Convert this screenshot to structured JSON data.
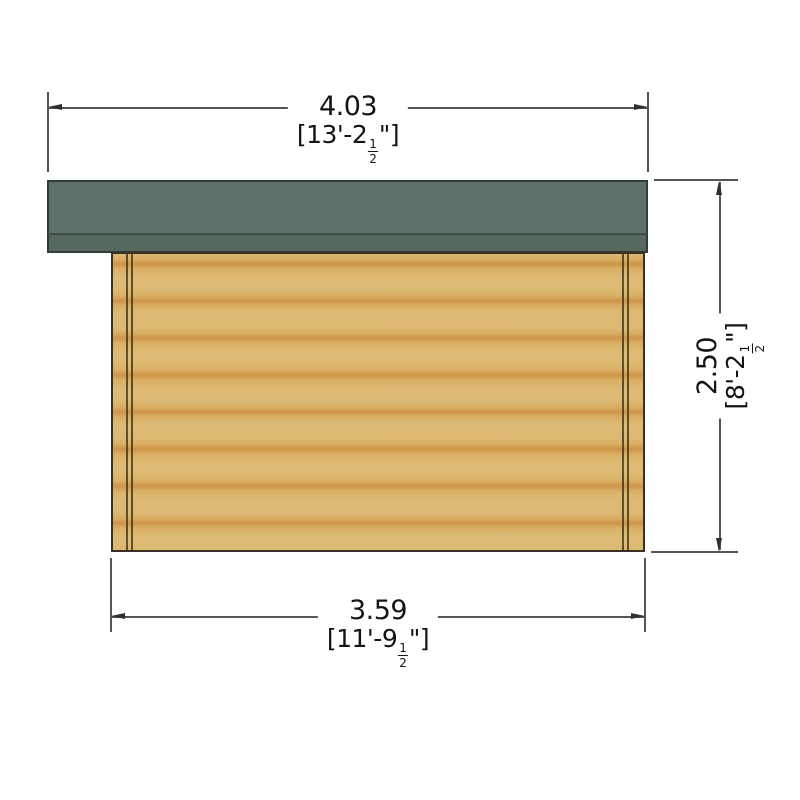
{
  "drawing": {
    "dimensions": {
      "top": {
        "metric_m": "4.03",
        "imperial_prefix": "[13'-2",
        "fraction_numerator": "1",
        "fraction_denominator": "2",
        "imperial_suffix": "\"]"
      },
      "right": {
        "metric_m": "2.50",
        "imperial_prefix": "[8'-2",
        "fraction_numerator": "1",
        "fraction_denominator": "2",
        "imperial_suffix": "\"]"
      },
      "bottom": {
        "metric_m": "3.59",
        "imperial_prefix": "[11'-9",
        "fraction_numerator": "1",
        "fraction_denominator": "2",
        "imperial_suffix": "\"]"
      }
    },
    "colors": {
      "roof_main": "#5d7168",
      "roof_fascia": "#57695f",
      "wall_light": "#debb74",
      "wall_dark": "#cf9448",
      "outline": "#35302a",
      "dimension_line": "#565656",
      "text": "#141414",
      "background": "#ffffff"
    }
  }
}
